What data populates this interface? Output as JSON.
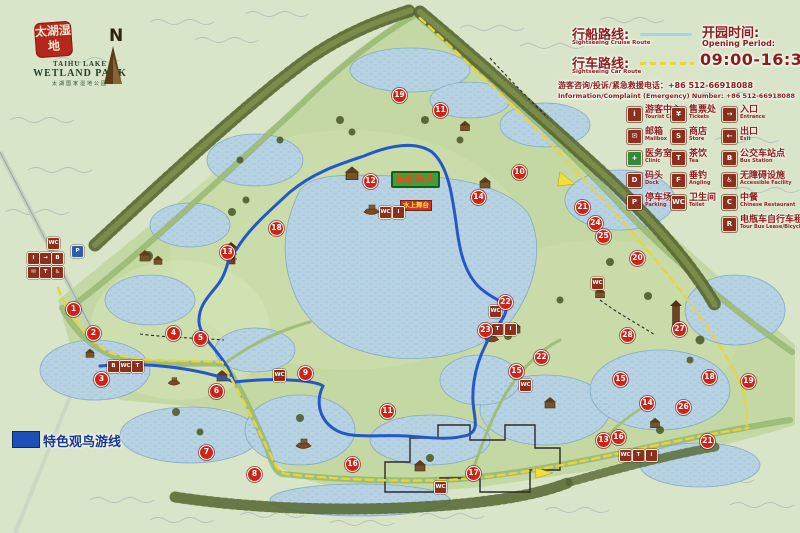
{
  "app": {
    "title_zh": "太湖湿地公园导览图"
  },
  "logo": {
    "seal": "太湖湿地",
    "name_line1": "TAIHU LAKE",
    "name_line2": "WETLAND PARK",
    "subtitle_zh": "太湖国家湿地公园"
  },
  "compass": {
    "label": "N"
  },
  "routes_legend": {
    "cruise_zh": "行船路线:",
    "cruise_en": "Sightseeing Cruise Route",
    "car_zh": "行车路线:",
    "car_en": "Sightseeing Car Route",
    "opening_zh": "开园时间:",
    "opening_en": "Opening Period:",
    "opening_time": "09:00-16:30",
    "hotline_zh": "游客咨询/投诉/紧急救援电话：+86 512-66918088",
    "hotline_en": "Information/Complaint (Emergency) Number: +86 512-66918088"
  },
  "colors": {
    "cruise_route_line": "#9ed7ee",
    "car_route_line": "#e8d53c",
    "cruise_route_on_map": "#2458c8",
    "bird_route": "#1d4fb8",
    "marker_red": "#cf2318",
    "legend_text": "#8b1c1c"
  },
  "facilities_legend": {
    "columns": [
      [
        {
          "zh": "游客中心",
          "en": "Tourist Center",
          "glyph": "i"
        },
        {
          "zh": "邮箱",
          "en": "Mailbox",
          "glyph": "✉"
        },
        {
          "zh": "医务室",
          "en": "Clinic",
          "glyph": "+",
          "bg": "#2e8b3a"
        },
        {
          "zh": "码头",
          "en": "Dock",
          "glyph": "D"
        },
        {
          "zh": "停车场",
          "en": "Parking",
          "glyph": "P"
        }
      ],
      [
        {
          "zh": "售票处",
          "en": "Tickets",
          "glyph": "¥"
        },
        {
          "zh": "商店",
          "en": "Store",
          "glyph": "S"
        },
        {
          "zh": "茶饮",
          "en": "Tea",
          "glyph": "T"
        },
        {
          "zh": "垂钓",
          "en": "Angling",
          "glyph": "F"
        },
        {
          "zh": "卫生间",
          "en": "Toilet",
          "glyph": "WC"
        }
      ],
      [
        {
          "zh": "入口",
          "en": "Entrance",
          "glyph": "→"
        },
        {
          "zh": "出口",
          "en": "Exit",
          "glyph": "←"
        },
        {
          "zh": "公交车站点",
          "en": "Bus Station",
          "glyph": "B"
        },
        {
          "zh": "无障碍设施",
          "en": "Accessible Facility",
          "glyph": "♿"
        },
        {
          "zh": "中餐",
          "en": "Chinese Restaurant",
          "glyph": "C"
        },
        {
          "zh": "电瓶车自行车租赁",
          "en": "Tour Bus Lease/Bicycle Lease",
          "glyph": "R"
        }
      ]
    ]
  },
  "bird_legend": {
    "label": "特色观鸟游线"
  },
  "signs": {
    "green_sign": "游船码头",
    "red_sign": "水上舞台"
  },
  "markers": [
    {
      "n": "1",
      "x": 73,
      "y": 309
    },
    {
      "n": "2",
      "x": 93,
      "y": 333
    },
    {
      "n": "3",
      "x": 101,
      "y": 379
    },
    {
      "n": "4",
      "x": 173,
      "y": 333
    },
    {
      "n": "5",
      "x": 200,
      "y": 338
    },
    {
      "n": "6",
      "x": 216,
      "y": 391
    },
    {
      "n": "7",
      "x": 206,
      "y": 452
    },
    {
      "n": "8",
      "x": 254,
      "y": 474
    },
    {
      "n": "9",
      "x": 305,
      "y": 373
    },
    {
      "n": "10",
      "x": 519,
      "y": 172
    },
    {
      "n": "11",
      "x": 387,
      "y": 411
    },
    {
      "n": "12",
      "x": 370,
      "y": 181
    },
    {
      "n": "13",
      "x": 227,
      "y": 252
    },
    {
      "n": "14",
      "x": 478,
      "y": 197
    },
    {
      "n": "15",
      "x": 516,
      "y": 371
    },
    {
      "n": "16",
      "x": 352,
      "y": 464
    },
    {
      "n": "17",
      "x": 473,
      "y": 473
    },
    {
      "n": "18",
      "x": 276,
      "y": 228
    },
    {
      "n": "19",
      "x": 399,
      "y": 95
    },
    {
      "n": "20",
      "x": 637,
      "y": 258
    },
    {
      "n": "21",
      "x": 582,
      "y": 207
    },
    {
      "n": "22",
      "x": 505,
      "y": 302
    },
    {
      "n": "23",
      "x": 485,
      "y": 330
    },
    {
      "n": "24",
      "x": 595,
      "y": 223
    },
    {
      "n": "25",
      "x": 603,
      "y": 236
    },
    {
      "n": "26",
      "x": 683,
      "y": 407
    },
    {
      "n": "27",
      "x": 679,
      "y": 329
    },
    {
      "n": "28",
      "x": 627,
      "y": 335
    },
    {
      "n": "11",
      "x": 440,
      "y": 110
    },
    {
      "n": "22",
      "x": 541,
      "y": 357
    },
    {
      "n": "14",
      "x": 647,
      "y": 403
    },
    {
      "n": "15",
      "x": 620,
      "y": 379
    },
    {
      "n": "18",
      "x": 709,
      "y": 377
    },
    {
      "n": "19",
      "x": 748,
      "y": 381
    },
    {
      "n": "13",
      "x": 603,
      "y": 440
    },
    {
      "n": "16",
      "x": 618,
      "y": 437
    },
    {
      "n": "21",
      "x": 707,
      "y": 441
    }
  ],
  "map_icons": [
    {
      "x": 53,
      "y": 243,
      "g": "WC"
    },
    {
      "x": 77,
      "y": 251,
      "g": "P",
      "bg": "#2b5fae"
    },
    {
      "x": 33,
      "y": 258,
      "g": "i"
    },
    {
      "x": 45,
      "y": 258,
      "g": "→"
    },
    {
      "x": 57,
      "y": 258,
      "g": "B"
    },
    {
      "x": 33,
      "y": 272,
      "g": "✉"
    },
    {
      "x": 45,
      "y": 272,
      "g": "T"
    },
    {
      "x": 57,
      "y": 272,
      "g": "♿"
    },
    {
      "x": 385,
      "y": 212,
      "g": "WC"
    },
    {
      "x": 398,
      "y": 212,
      "g": "i"
    },
    {
      "x": 113,
      "y": 366,
      "g": "B"
    },
    {
      "x": 125,
      "y": 366,
      "g": "WC"
    },
    {
      "x": 137,
      "y": 366,
      "g": "T"
    },
    {
      "x": 279,
      "y": 375,
      "g": "WC"
    },
    {
      "x": 495,
      "y": 311,
      "g": "WC"
    },
    {
      "x": 497,
      "y": 329,
      "g": "T"
    },
    {
      "x": 510,
      "y": 329,
      "g": "i"
    },
    {
      "x": 525,
      "y": 385,
      "g": "WC"
    },
    {
      "x": 597,
      "y": 283,
      "g": "WC"
    },
    {
      "x": 625,
      "y": 455,
      "g": "WC"
    },
    {
      "x": 638,
      "y": 455,
      "g": "T"
    },
    {
      "x": 651,
      "y": 455,
      "g": "i"
    },
    {
      "x": 440,
      "y": 487,
      "g": "WC"
    }
  ]
}
